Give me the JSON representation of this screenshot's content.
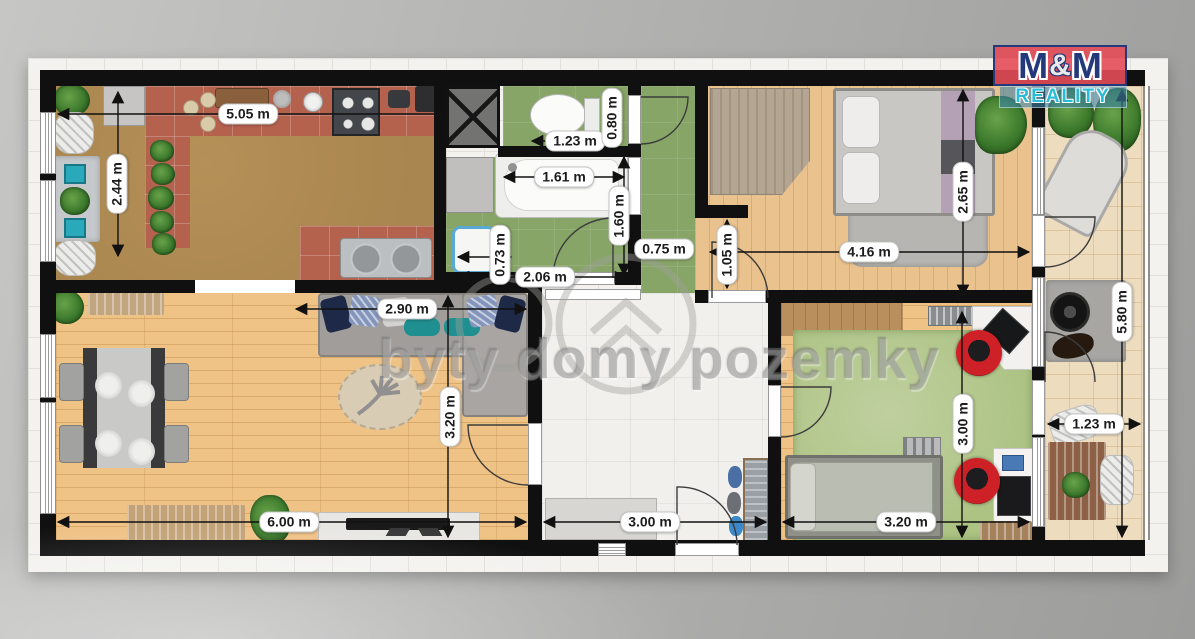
{
  "logo": {
    "m1": "M",
    "amp": "&",
    "m2": "M",
    "subtitle": "REALITY",
    "red": "#e54d58",
    "navy": "#24397a",
    "teal": "#27bcd8"
  },
  "watermark": {
    "text": "byty domy pozemky"
  },
  "dimensions": {
    "kitchen_width": "5.05 m",
    "kitchen_depth": "2.44 m",
    "wc_width": "1.23 m",
    "wc_depth": "0.80 m",
    "bathtub_length": "1.61 m",
    "bathtub_width": "1.60 m",
    "basin_width": "0.73 m",
    "bathroom_width": "2.06 m",
    "corridor_width": "0.75 m",
    "bedroom_entry_width": "1.05 m",
    "bedroom_width": "4.16 m",
    "bedroom_depth": "2.65 m",
    "sofa_width": "2.90 m",
    "living_depth": "3.20 m",
    "living_width": "6.00 m",
    "hall_width": "3.00 m",
    "kids_room_width": "3.20 m",
    "kids_room_depth": "3.00 m",
    "balcony_length": "5.80 m",
    "balcony_width": "1.23 m"
  }
}
